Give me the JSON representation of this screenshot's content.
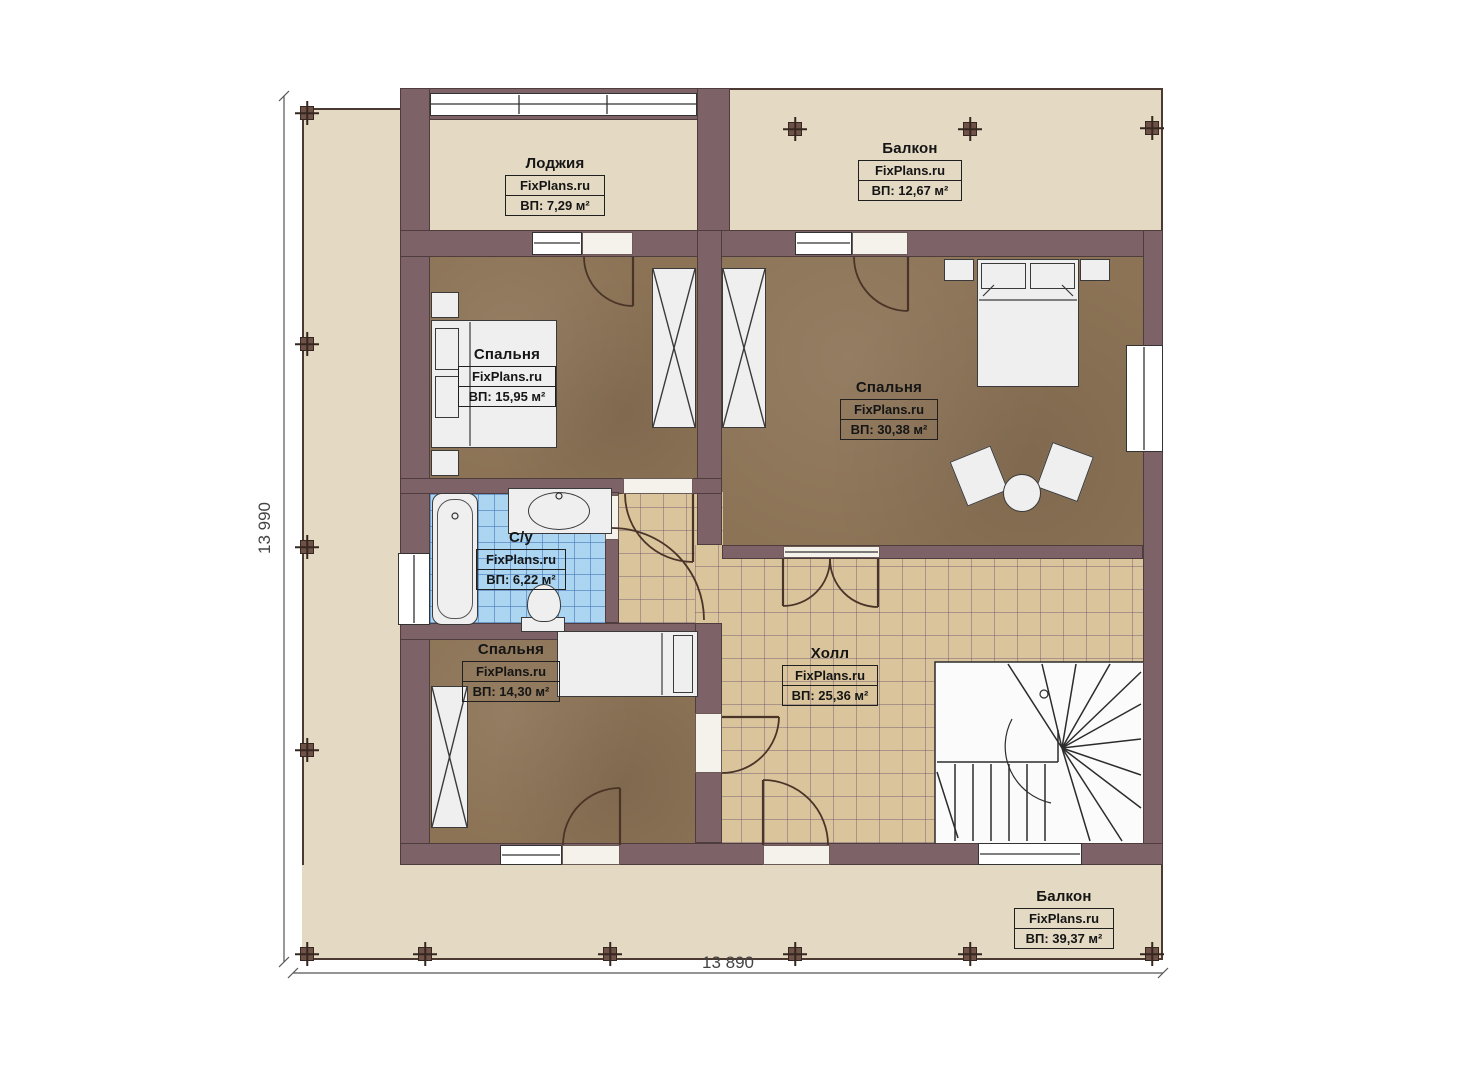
{
  "plan": {
    "dim_left": "13 990",
    "dim_bottom": "13 890"
  },
  "rooms": [
    {
      "id": "loggia",
      "name": "Лоджия",
      "brand": "FixPlans.ru",
      "area": "ВП: 7,29 м²"
    },
    {
      "id": "balcony-top",
      "name": "Балкон",
      "brand": "FixPlans.ru",
      "area": "ВП: 12,67 м²"
    },
    {
      "id": "bedroom-1",
      "name": "Спальня",
      "brand": "FixPlans.ru",
      "area": "ВП: 15,95 м²"
    },
    {
      "id": "bedroom-2",
      "name": "Спальня",
      "brand": "FixPlans.ru",
      "area": "ВП: 30,38 м²"
    },
    {
      "id": "bathroom",
      "name": "С/у",
      "brand": "FixPlans.ru",
      "area": "ВП: 6,22 м²"
    },
    {
      "id": "bedroom-3",
      "name": "Спальня",
      "brand": "FixPlans.ru",
      "area": "ВП: 14,30 м²"
    },
    {
      "id": "hall",
      "name": "Холл",
      "brand": "FixPlans.ru",
      "area": "ВП: 25,36 м²"
    },
    {
      "id": "balcony-bottom",
      "name": "Балкон",
      "brand": "FixPlans.ru",
      "area": "ВП: 39,37 м²"
    }
  ],
  "colors": {
    "terrace": "#e4d9c3",
    "wall": "#7d6367",
    "bedroom_floor": "#8c7356",
    "hall_tile": "#d9c49c",
    "bath_tile": "#abd5f1",
    "furniture": "#efefef",
    "outline": "#3a2f2b"
  }
}
